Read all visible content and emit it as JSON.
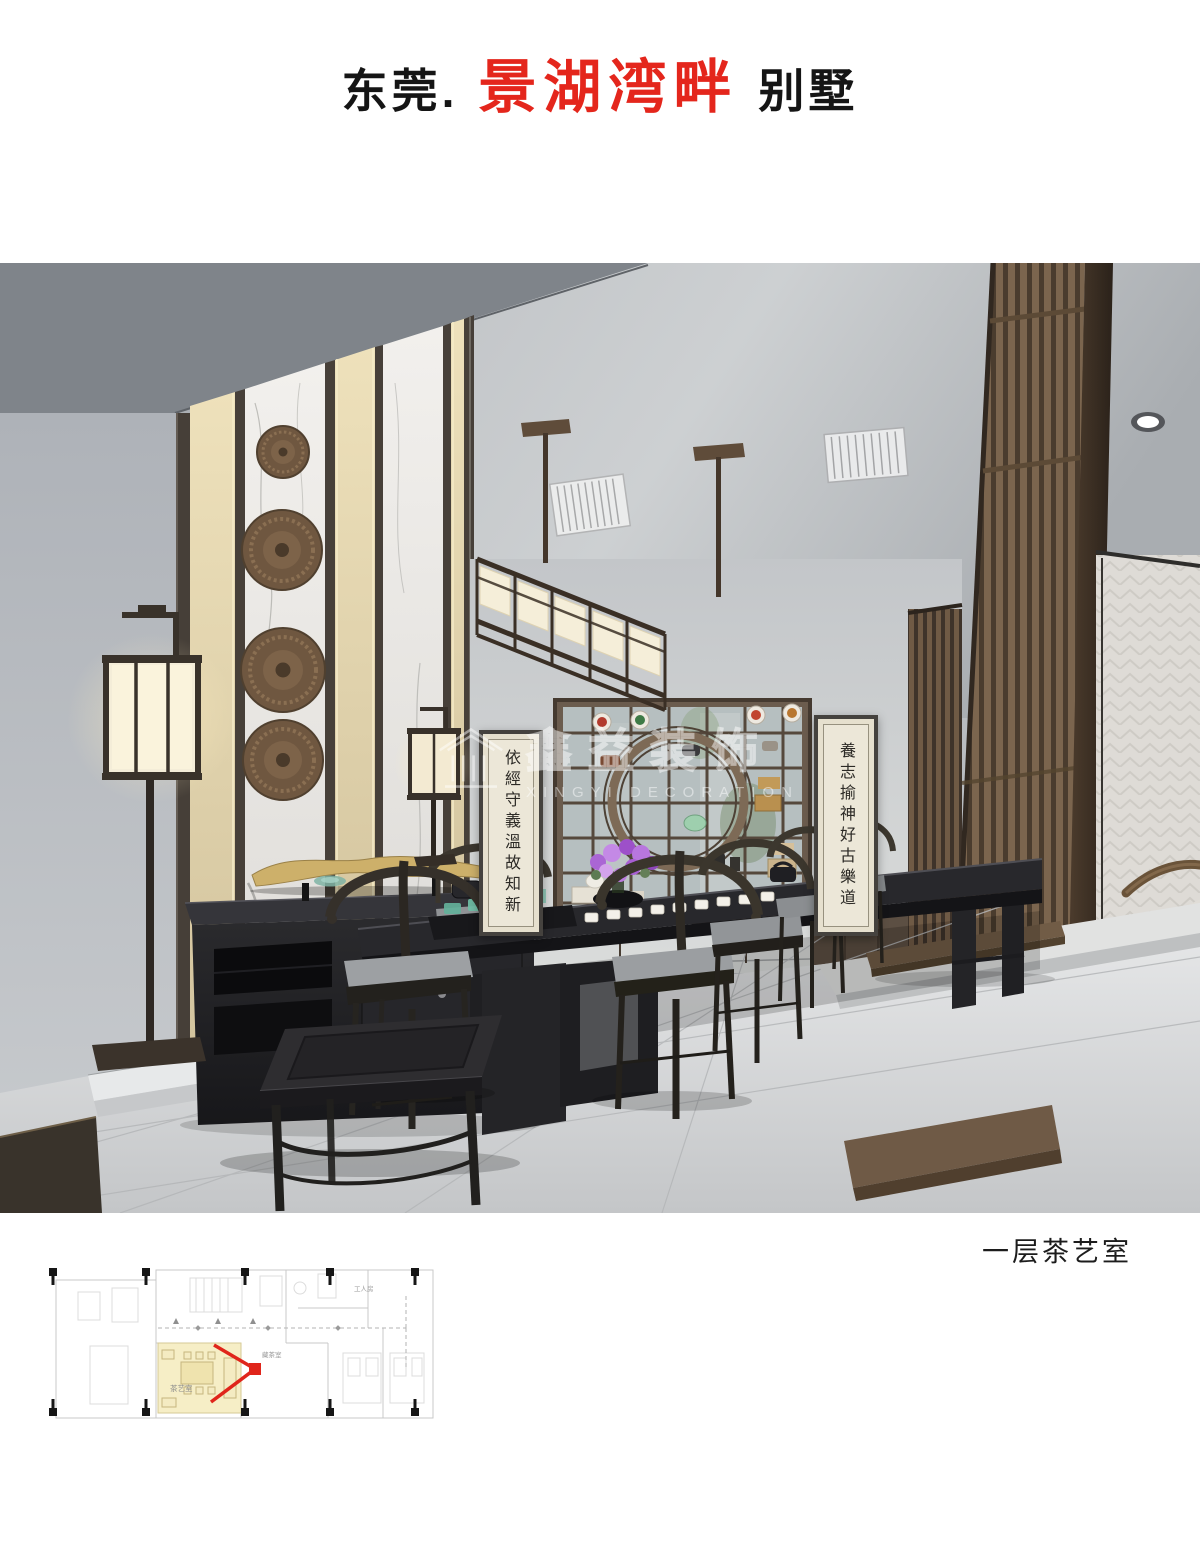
{
  "header": {
    "title_prefix": "东莞.",
    "title_highlight": "景湖湾畔",
    "title_suffix": "别墅",
    "highlight_color": "#e4261c",
    "text_color": "#151515"
  },
  "caption": "一层茶艺室",
  "scene": {
    "scroll_left": "依經守義溫故知新",
    "scroll_right": "養志揄神好古樂道",
    "watermark_cn": "鑫益装饰",
    "watermark_en": "XINGYI DECORATION"
  },
  "floorplan": {
    "highlight_color": "#f6eec6",
    "marker_color": "#e0251b",
    "labels": [
      {
        "text": "茶艺室"
      },
      {
        "text": "藏茶室"
      },
      {
        "text": "工人房"
      }
    ]
  }
}
